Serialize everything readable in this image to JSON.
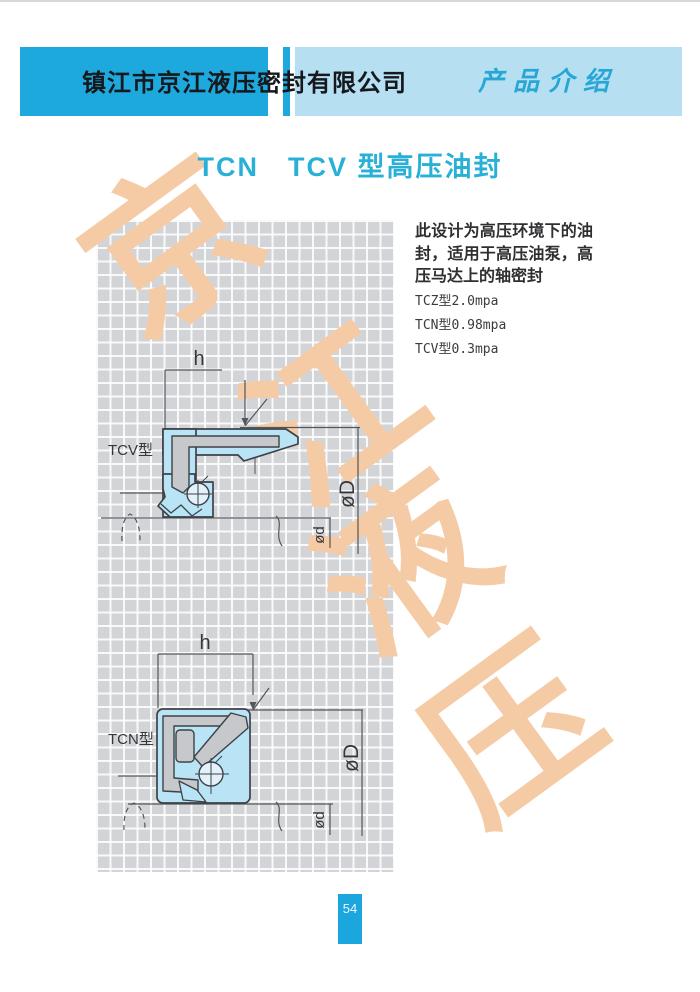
{
  "header": {
    "company": "镇江市京江液压密封有限公司",
    "section": "产品介绍"
  },
  "title": "TCN　TCV 型高压油封",
  "intro": {
    "description": "此设计为高压环境下的油封，适用于高压油泵，高压马达上的轴密封",
    "specs": [
      "TCZ型2.0mpa",
      "TCN型0.98mpa",
      "TCV型0.3mpa"
    ]
  },
  "diagrams": [
    {
      "label": "TCV型",
      "height_dim": "h",
      "outer_dia": "øD",
      "shaft_dia": "ød"
    },
    {
      "label": "TCN型",
      "height_dim": "h",
      "outer_dia": "øD",
      "shaft_dia": "ød"
    }
  ],
  "watermark": {
    "chars": [
      "京",
      "江",
      "液",
      "压"
    ],
    "color": "#f5cba6"
  },
  "page_number": "54",
  "colors": {
    "header_bar": "#1ea9de",
    "header_bar_light": "#b6e0f2",
    "section_text": "#28a7d6",
    "title_text": "#28b0d6",
    "grid_bg": "#d3d4d8",
    "seal_fill": "#b9e4f5",
    "metal_fill": "#c6c8cb",
    "line": "#4a4d52",
    "watermark": "#f5cba6",
    "page_badge": "#1ba6de"
  }
}
